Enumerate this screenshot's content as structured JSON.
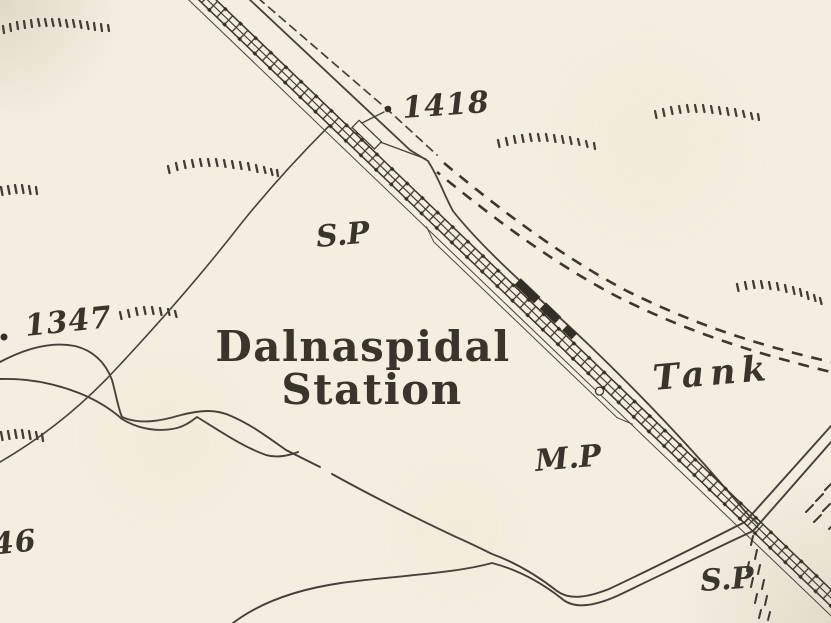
{
  "map": {
    "type": "historic-ordnance-survey-extract",
    "labels": {
      "station_name_line1": "Dalnaspidal",
      "station_name_line2": "Station",
      "spot_height_1418": "1418",
      "spot_height_1347": "1347",
      "spot_height_46": "46",
      "signal_post_upper": "S.P",
      "signal_post_lower": "S.P",
      "mile_post": "M.P",
      "tank": "Tank"
    },
    "colors": {
      "paper": "#f3eedf",
      "ink": "#3a362c"
    }
  }
}
